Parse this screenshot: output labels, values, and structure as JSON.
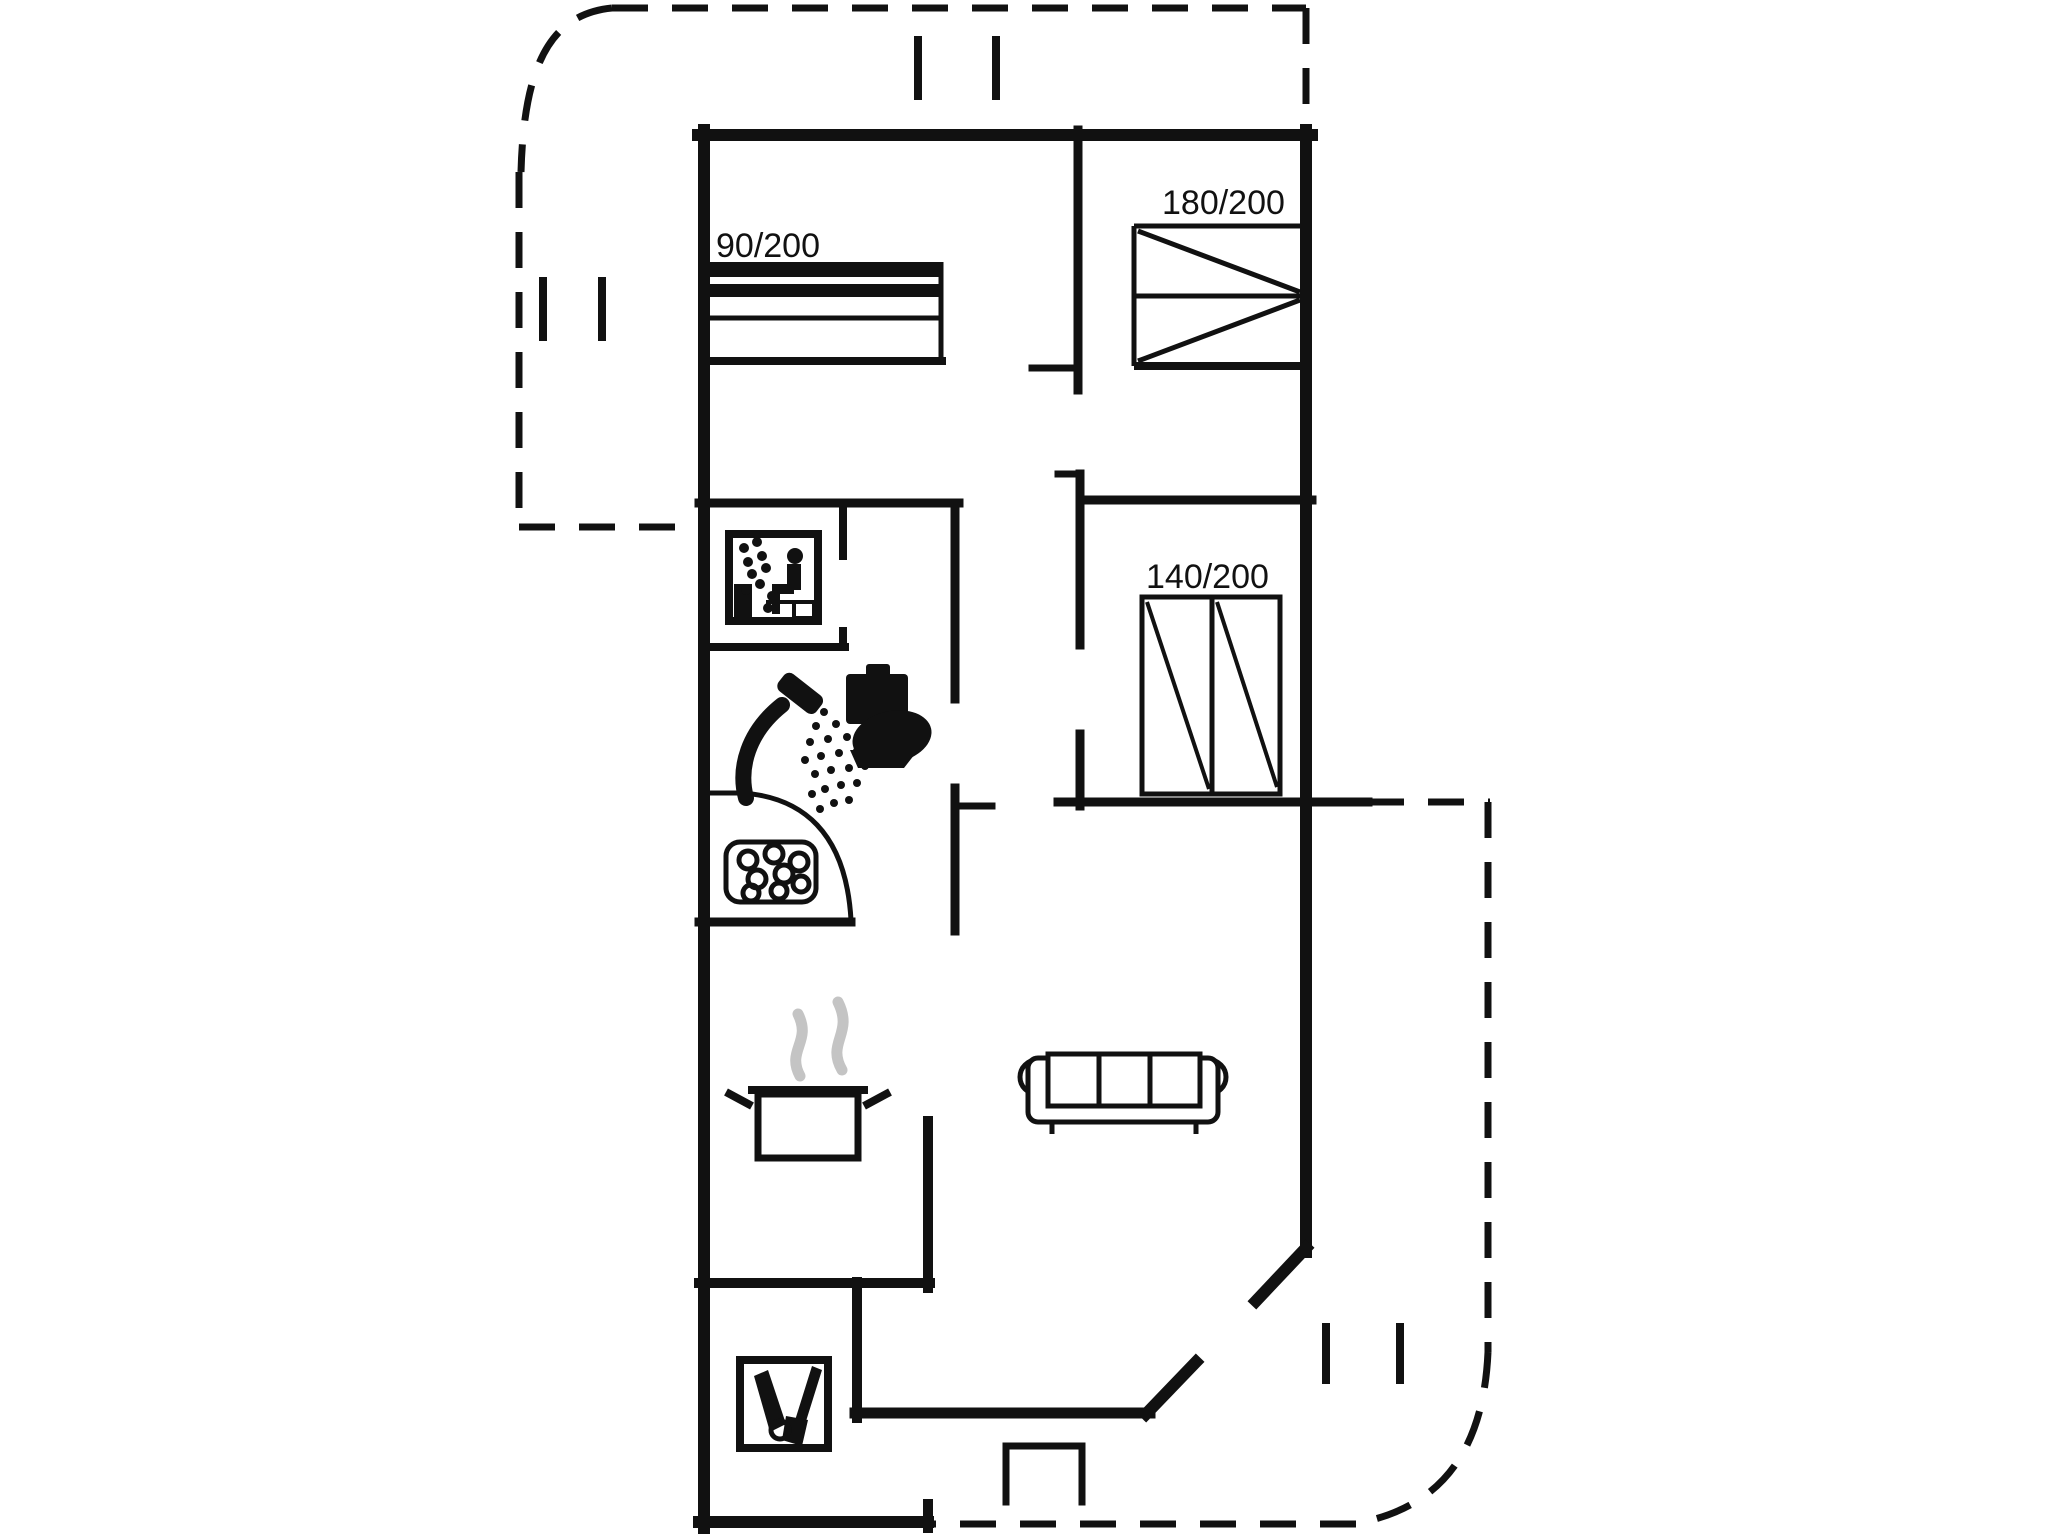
{
  "document": {
    "type": "floor-plan",
    "description": "Single-storey holiday house floor plan with terrace outlines"
  },
  "labels": {
    "bed_single": "90/200",
    "bed_double_large": "180/200",
    "bed_double": "140/200"
  },
  "icons": [
    "sauna-icon",
    "shower-icon",
    "toilet-icon",
    "whirlpool-icon",
    "stove-pot-icon",
    "sofa",
    "cleaning-equipment-icon"
  ],
  "colors": {
    "line": "#111111",
    "steam": "#c4c4c4",
    "background": "#ffffff"
  }
}
